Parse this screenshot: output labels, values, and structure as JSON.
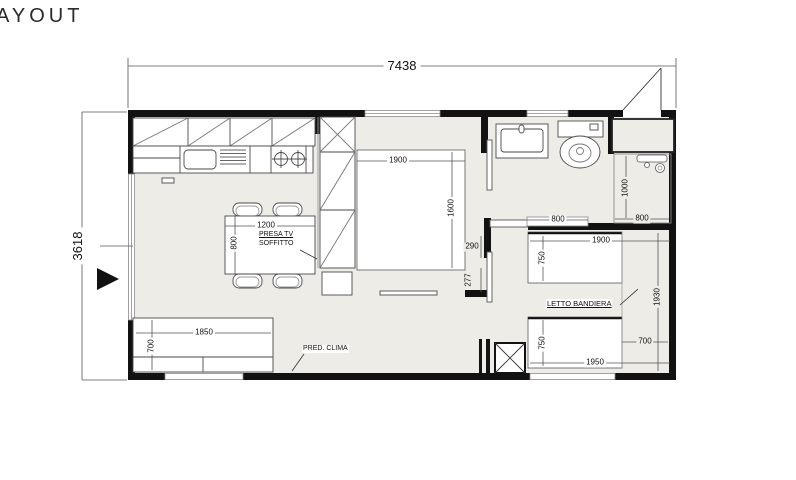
{
  "title": "AYOUT",
  "colors": {
    "wall": "#121212",
    "floor": "#edece6",
    "furniture_line": "#4a4a4a",
    "dim_line": "#555555"
  },
  "dims": {
    "overall": {
      "width": "7438",
      "height": "3618"
    },
    "main_bed": {
      "width": "1900",
      "depth": "1600"
    },
    "table": {
      "width": "1200",
      "depth": "800"
    },
    "sofa": {
      "width": "1850",
      "depth": "700"
    },
    "walls": {
      "seg_a": "290",
      "seg_b": "277"
    },
    "bath": {
      "shelf_width": "800",
      "shower_depth": "1000",
      "shower_width": "800"
    },
    "bedroom2": {
      "bed_top_width": "1900",
      "bed_top_depth": "750",
      "bed_bottom_depth": "750",
      "bed_bottom_width": "1950",
      "room_depth": "1930",
      "side_space": "700"
    }
  },
  "labels": {
    "presa_tv_line1": "PRESA TV",
    "presa_tv_line2": "SOFFITTO",
    "pred_clima": "PRED. CLIMA",
    "letto_bandiera": "LETTO BANDIERA"
  }
}
